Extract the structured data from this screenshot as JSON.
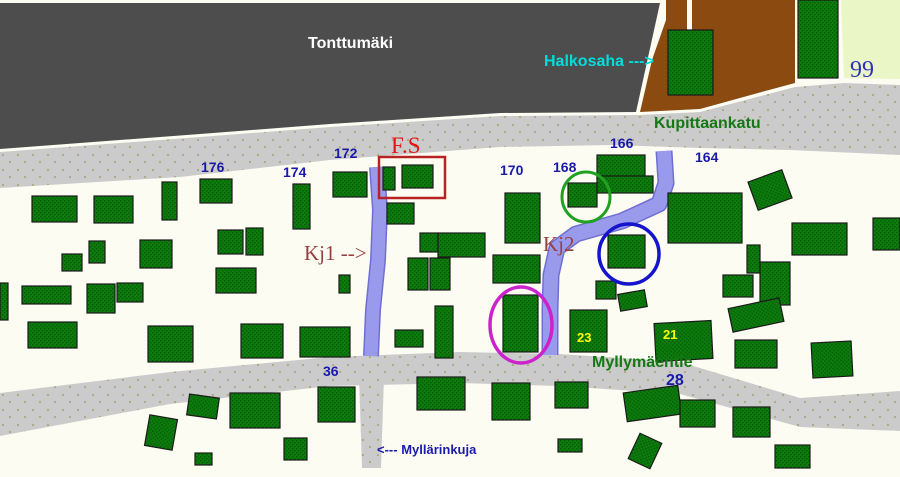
{
  "canvas": {
    "width": 900,
    "height": 477
  },
  "colors": {
    "ground": "#fcfcf3",
    "hill": "#4d4d4d",
    "road": "#cbcbcb",
    "road_dot": "#a9a982",
    "building": "#0c7c0c",
    "building_dark": "#075907",
    "building_edge": "#1b1b1b",
    "wood_yard": "#8b4a10",
    "field": "#eaf6c6",
    "walkway": "#9a9aec",
    "walkway_edge": "#6f6fd2",
    "highlight_red": "#b82222",
    "circle_green": "#21a121",
    "circle_blue": "#1414cc",
    "circle_magenta": "#cc22cc",
    "text_blue": "#1a1aaa",
    "text_yellow": "#fcfc02",
    "text_maroon": "#994040",
    "text_cyan": "#00dddd",
    "text_green": "#157815",
    "text_white": "#ffffff",
    "text_red": "#e31414",
    "text_blue_serif": "#3030c0"
  },
  "terrain": [
    {
      "id": "field-99-area",
      "fill": "field",
      "points": "841,0 900,0 900,79 844,78"
    },
    {
      "id": "tonttumaki-hill",
      "fill": "hill",
      "points": "0,3 660,3 636,112 500,113 330,124 200,134 0,149"
    },
    {
      "id": "woodyard-area",
      "fill": "wood_yard",
      "points": "666,0 795,0 795,83 758,93 700,109 640,112 652,60 666,20"
    },
    {
      "id": "woodyard-divider",
      "fill": "ground",
      "rect": [
        687,
        0,
        5,
        30
      ]
    },
    {
      "id": "road-kupittaankatu",
      "fill": "road",
      "points": "0,152 200,137 330,127 500,116 640,115 700,112 795,87 844,83 900,85 900,155 790,150 700,148 612,145 500,147 330,160 180,177 0,188"
    },
    {
      "id": "road-myllymaentie",
      "fill": "road",
      "points": "0,393 170,372 330,357 460,352 560,354 680,362 800,398 900,391 900,431 800,427 680,394 560,386 460,383 330,386 170,404 0,436"
    },
    {
      "id": "road-myllarinkuja",
      "fill": "road",
      "points": "359,377 384,377 381,468 362,468"
    }
  ],
  "walkways": [
    {
      "id": "walkway-kj1",
      "points": "377,167 380,210 378,260 373,310 371,356",
      "width": 13
    },
    {
      "id": "walkway-kj2",
      "points": "664,151 666,183 659,204 622,221 576,234 557,248 551,275 550,310 550,355",
      "width": 14
    }
  ],
  "buildings": [
    [
      668,
      30,
      45,
      65,
      0
    ],
    [
      798,
      0,
      40,
      78,
      0
    ],
    [
      32,
      196,
      45,
      26,
      0
    ],
    [
      94,
      196,
      39,
      27,
      0
    ],
    [
      162,
      182,
      15,
      38,
      0
    ],
    [
      200,
      179,
      32,
      24,
      0
    ],
    [
      293,
      184,
      17,
      45,
      0
    ],
    [
      333,
      172,
      34,
      25,
      0
    ],
    [
      383,
      167,
      12,
      23,
      0
    ],
    [
      402,
      165,
      31,
      23,
      0
    ],
    [
      387,
      203,
      27,
      21,
      0
    ],
    [
      505,
      193,
      35,
      50,
      0
    ],
    [
      568,
      183,
      29,
      24,
      0
    ],
    [
      597,
      155,
      48,
      24,
      0
    ],
    [
      597,
      176,
      56,
      17,
      0
    ],
    [
      668,
      193,
      74,
      50,
      0
    ],
    [
      752,
      175,
      36,
      30,
      -20
    ],
    [
      792,
      223,
      55,
      32,
      0
    ],
    [
      873,
      218,
      27,
      32,
      0
    ],
    [
      89,
      241,
      16,
      22,
      0
    ],
    [
      62,
      254,
      20,
      17,
      0
    ],
    [
      140,
      240,
      32,
      28,
      0
    ],
    [
      218,
      230,
      25,
      24,
      0
    ],
    [
      246,
      228,
      17,
      27,
      0
    ],
    [
      216,
      268,
      40,
      25,
      0
    ],
    [
      22,
      286,
      49,
      18,
      0
    ],
    [
      87,
      284,
      28,
      29,
      0
    ],
    [
      117,
      283,
      26,
      19,
      0
    ],
    [
      0,
      283,
      8,
      37,
      0
    ],
    [
      420,
      233,
      18,
      19,
      0
    ],
    [
      438,
      233,
      47,
      24,
      0
    ],
    [
      408,
      258,
      20,
      32,
      0
    ],
    [
      430,
      258,
      20,
      32,
      0
    ],
    [
      339,
      275,
      11,
      18,
      0
    ],
    [
      493,
      255,
      47,
      28,
      0
    ],
    [
      608,
      235,
      37,
      33,
      0
    ],
    [
      596,
      281,
      20,
      18,
      0
    ],
    [
      619,
      292,
      27,
      17,
      -10
    ],
    [
      747,
      245,
      13,
      28,
      0
    ],
    [
      723,
      275,
      30,
      22,
      0
    ],
    [
      760,
      262,
      30,
      43,
      0
    ],
    [
      503,
      295,
      35,
      57,
      0
    ],
    [
      570,
      310,
      37,
      42,
      0
    ],
    [
      655,
      322,
      57,
      38,
      -3
    ],
    [
      730,
      303,
      52,
      24,
      -12
    ],
    [
      735,
      340,
      42,
      28,
      0
    ],
    [
      812,
      342,
      40,
      35,
      -3
    ],
    [
      28,
      322,
      49,
      26,
      0
    ],
    [
      148,
      326,
      45,
      36,
      0
    ],
    [
      241,
      324,
      42,
      34,
      0
    ],
    [
      300,
      327,
      50,
      30,
      0
    ],
    [
      395,
      330,
      28,
      17,
      0
    ],
    [
      435,
      306,
      18,
      52,
      0
    ],
    [
      188,
      396,
      30,
      21,
      8
    ],
    [
      230,
      393,
      50,
      35,
      0
    ],
    [
      284,
      438,
      23,
      22,
      0
    ],
    [
      318,
      387,
      37,
      35,
      0
    ],
    [
      195,
      453,
      17,
      12,
      0
    ],
    [
      147,
      417,
      28,
      31,
      10
    ],
    [
      417,
      377,
      48,
      33,
      0
    ],
    [
      492,
      383,
      38,
      37,
      0
    ],
    [
      555,
      382,
      33,
      26,
      0
    ],
    [
      625,
      389,
      55,
      29,
      -8
    ],
    [
      558,
      439,
      24,
      13,
      0
    ],
    [
      633,
      437,
      24,
      28,
      25
    ],
    [
      680,
      400,
      35,
      27,
      0
    ],
    [
      733,
      407,
      37,
      30,
      0
    ],
    [
      775,
      445,
      35,
      23,
      0
    ]
  ],
  "annotations": [
    {
      "id": "fs-highlight-box",
      "type": "rect",
      "x": 379,
      "y": 157,
      "w": 66,
      "h": 41,
      "color": "highlight_red",
      "sw": 2.5
    },
    {
      "id": "green-circle",
      "type": "ellipse",
      "cx": 586,
      "cy": 197,
      "rx": 24,
      "ry": 25,
      "color": "circle_green",
      "sw": 3
    },
    {
      "id": "blue-circle",
      "type": "ellipse",
      "cx": 629,
      "cy": 254,
      "rx": 30,
      "ry": 30,
      "color": "circle_blue",
      "sw": 3.5
    },
    {
      "id": "magenta-ellipse",
      "type": "ellipse",
      "cx": 521,
      "cy": 325,
      "rx": 31,
      "ry": 38,
      "color": "circle_magenta",
      "sw": 3.5
    }
  ],
  "labels": [
    {
      "id": "tonttumaki",
      "text": "Tonttumäki",
      "x": 308,
      "y": 36,
      "size": 16,
      "color": "text_white",
      "font": "sans",
      "bold": true
    },
    {
      "id": "halkosaha",
      "text": "Halkosaha --->",
      "x": 544,
      "y": 54,
      "size": 16,
      "color": "text_cyan",
      "font": "sans",
      "bold": true
    },
    {
      "id": "number-99",
      "text": "99",
      "x": 850,
      "y": 58,
      "size": 24,
      "color": "text_blue_serif",
      "font": "serif",
      "bold": false
    },
    {
      "id": "kupittaankatu",
      "text": "Kupittaankatu",
      "x": 654,
      "y": 116,
      "size": 16,
      "color": "text_green",
      "font": "sans",
      "bold": true
    },
    {
      "id": "number-176",
      "text": "176",
      "x": 201,
      "y": 160,
      "size": 14,
      "color": "text_blue",
      "font": "sans",
      "bold": true
    },
    {
      "id": "number-174",
      "text": "174",
      "x": 283,
      "y": 165,
      "size": 14,
      "color": "text_blue",
      "font": "sans",
      "bold": true
    },
    {
      "id": "number-172",
      "text": "172",
      "x": 334,
      "y": 146,
      "size": 14,
      "color": "text_blue",
      "font": "sans",
      "bold": true
    },
    {
      "id": "fs",
      "text": "F.S",
      "x": 391,
      "y": 134,
      "size": 23,
      "color": "text_red",
      "font": "serif",
      "bold": false
    },
    {
      "id": "number-170",
      "text": "170",
      "x": 500,
      "y": 163,
      "size": 14,
      "color": "text_blue",
      "font": "sans",
      "bold": true
    },
    {
      "id": "number-168",
      "text": "168",
      "x": 553,
      "y": 160,
      "size": 14,
      "color": "text_blue",
      "font": "sans",
      "bold": true
    },
    {
      "id": "number-166",
      "text": "166",
      "x": 610,
      "y": 136,
      "size": 14,
      "color": "text_blue",
      "font": "sans",
      "bold": true
    },
    {
      "id": "number-164",
      "text": "164",
      "x": 695,
      "y": 150,
      "size": 14,
      "color": "text_blue",
      "font": "sans",
      "bold": true
    },
    {
      "id": "kj1",
      "text": "Kj1 -->",
      "x": 304,
      "y": 243,
      "size": 21,
      "color": "text_maroon",
      "font": "serif",
      "bold": false
    },
    {
      "id": "kj2",
      "text": "Kj2",
      "x": 543,
      "y": 234,
      "size": 21,
      "color": "text_maroon",
      "font": "serif",
      "bold": false
    },
    {
      "id": "number-23",
      "text": "23",
      "x": 577,
      "y": 331,
      "size": 13,
      "color": "text_yellow",
      "font": "sans",
      "bold": true
    },
    {
      "id": "number-21",
      "text": "21",
      "x": 663,
      "y": 328,
      "size": 13,
      "color": "text_yellow",
      "font": "sans",
      "bold": true
    },
    {
      "id": "myllymaentie",
      "text": "Myllymäentie",
      "x": 592,
      "y": 355,
      "size": 16,
      "color": "text_green",
      "font": "sans",
      "bold": true
    },
    {
      "id": "number-28",
      "text": "28",
      "x": 666,
      "y": 373,
      "size": 16,
      "color": "text_blue",
      "font": "sans",
      "bold": true
    },
    {
      "id": "number-36",
      "text": "36",
      "x": 323,
      "y": 364,
      "size": 14,
      "color": "text_blue",
      "font": "sans",
      "bold": true
    },
    {
      "id": "myllarinkuja",
      "text": "<--- Myllärinkuja",
      "x": 377,
      "y": 443,
      "size": 13,
      "color": "text_blue",
      "font": "sans",
      "bold": true
    }
  ]
}
